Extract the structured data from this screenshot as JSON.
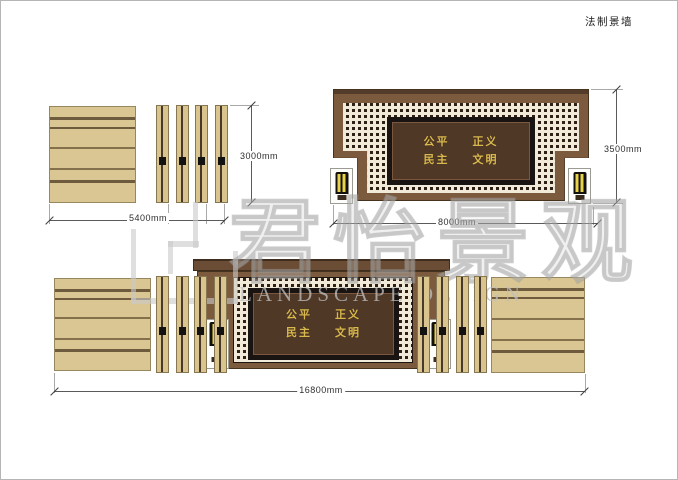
{
  "title": "法制景墙",
  "watermark": {
    "text_cn": "君怡景观",
    "text_en": "LANDSCAPE DESIGN"
  },
  "plaque": {
    "row1": "公平 正义",
    "row2": "民主 文明"
  },
  "dimensions": {
    "left_wall_width": "5400mm",
    "left_wall_height": "3000mm",
    "center_wall_width": "8000mm",
    "center_wall_height": "3500mm",
    "total_width": "16800mm"
  },
  "colors": {
    "wood_beige": "#d9c692",
    "wall_brown": "#7b5a3e",
    "cap_brown": "#5a4030",
    "plaque_bg": "#503827",
    "plaque_frame": "#191411",
    "lattice_bg": "#2e2014",
    "lattice_light": "#f2ead8",
    "gold_text": "#d9b94e",
    "lamp_yellow": "#e8d44a",
    "dim_line": "#5a5a5a"
  }
}
